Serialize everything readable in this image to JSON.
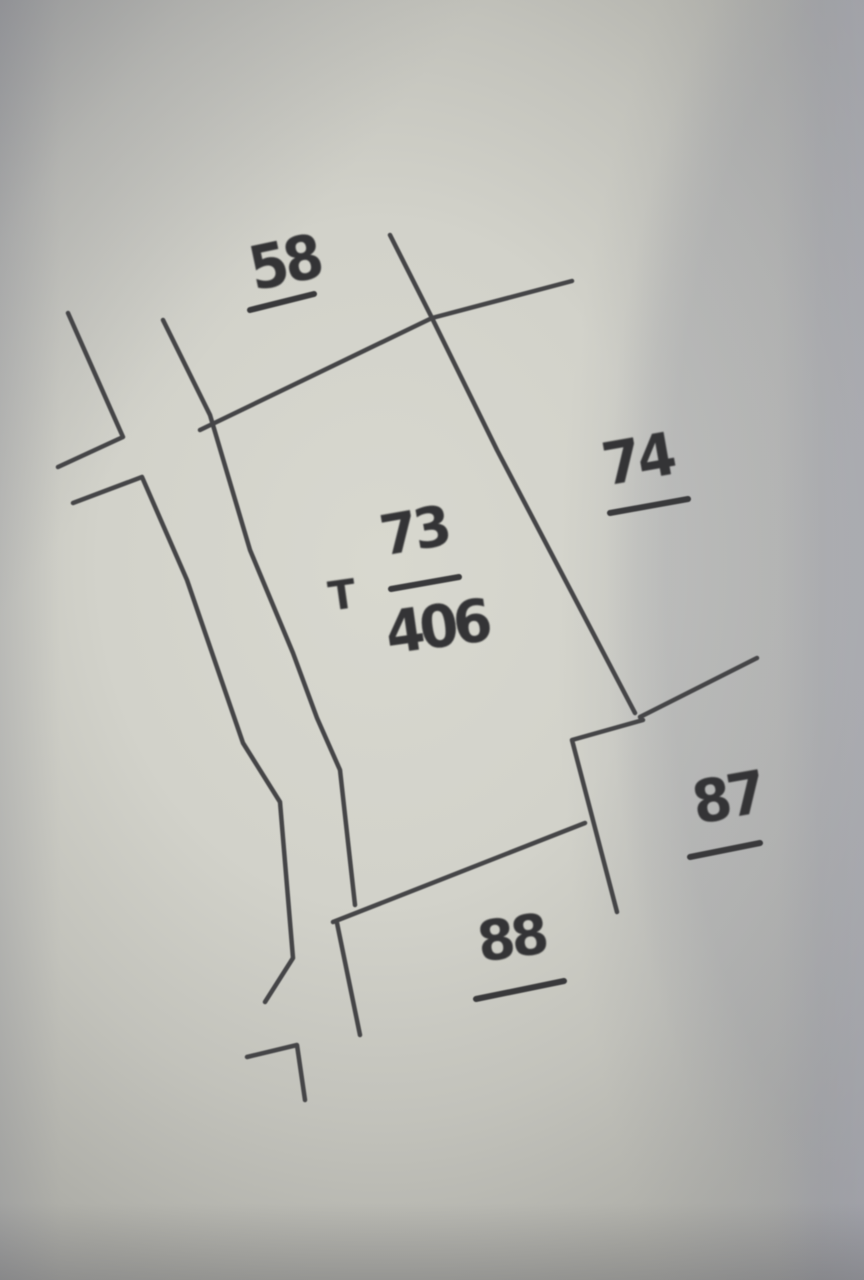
{
  "sketch": {
    "ink_color": "#454547",
    "marker_color": "#39393b",
    "paper_light": "#d8d8cf",
    "paper_dark": "#a2a2a0",
    "labels": {
      "parcel_58": "58",
      "parcel_74": "74",
      "house_mark": "T",
      "center_numerator": "73",
      "center_denominator": "406",
      "parcel_87": "87",
      "parcel_88": "88"
    },
    "lines": [
      {
        "name": "road-left-upper-segment",
        "points": "68,313 123,437 58,467",
        "width": 4.5
      },
      {
        "name": "road-left-main-segment",
        "points": "73,503 142,477 187,580 243,743 280,802 293,958 265,1002",
        "width": 4.5
      },
      {
        "name": "road-right-line",
        "points": "163,320 210,415 250,550 293,653 317,718 340,770 355,905",
        "width": 4.5
      },
      {
        "name": "road-right-lower-segment",
        "points": "337,923 360,1035",
        "width": 4.5
      },
      {
        "name": "north-boundary-line",
        "points": "200,430 432,318 572,281",
        "width": 4.5
      },
      {
        "name": "east-boundary-line",
        "points": "390,235 432,318 497,450 635,713",
        "width": 4.5
      },
      {
        "name": "parcel-87-north-edge",
        "points": "757,658 640,717",
        "width": 4.5
      },
      {
        "name": "parcel-87-west-edge",
        "points": "643,720 572,740 617,912",
        "width": 4.5
      },
      {
        "name": "south-boundary-line",
        "points": "333,922 585,823",
        "width": 4.5
      },
      {
        "name": "bottom-corner-mark",
        "points": "247,1057 297,1045 305,1100",
        "width": 4.5
      },
      {
        "name": "underline-58",
        "points": "250,310 314,294",
        "width": 6
      },
      {
        "name": "underline-74",
        "points": "610,513 688,499",
        "width": 6
      },
      {
        "name": "fraction-bar-73-406",
        "points": "391,589 459,577",
        "width": 6
      },
      {
        "name": "underline-87",
        "points": "690,857 760,843",
        "width": 6
      },
      {
        "name": "underline-88",
        "points": "476,999 564,981",
        "width": 6
      }
    ]
  }
}
